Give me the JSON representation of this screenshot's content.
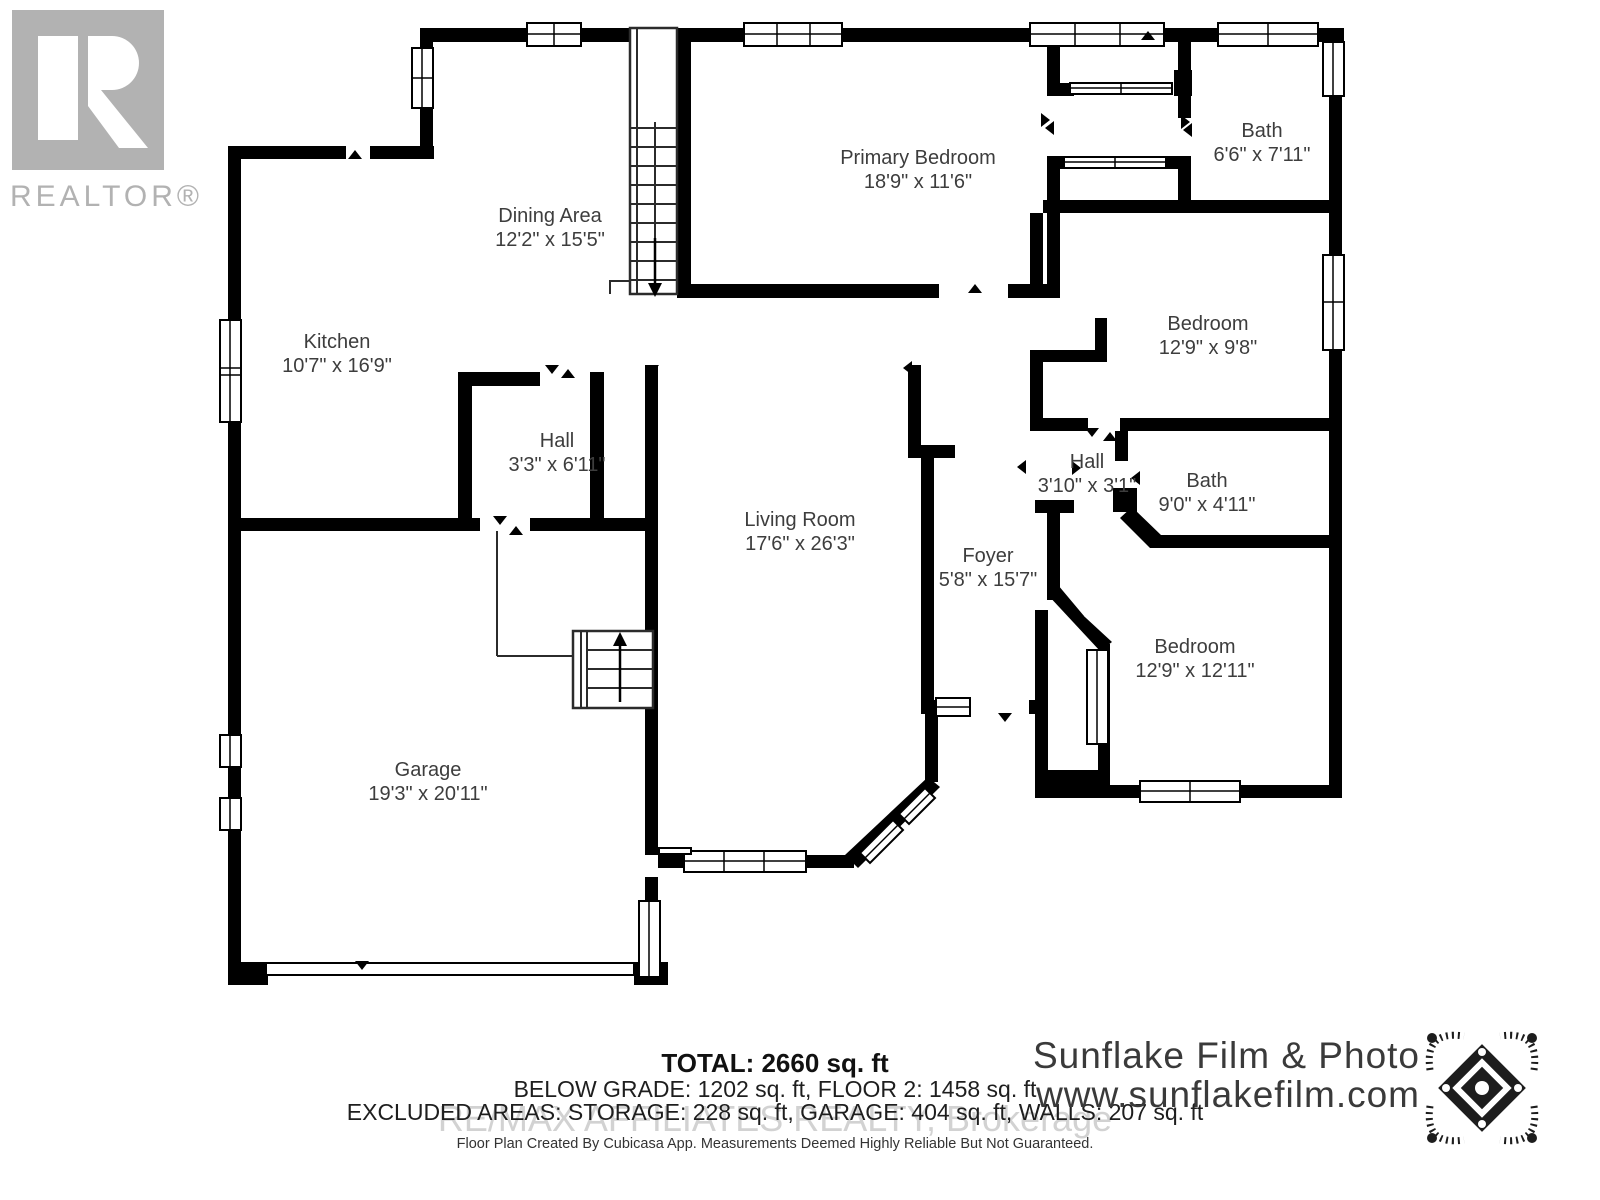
{
  "realtor": {
    "label": "REALTOR®"
  },
  "rooms": [
    {
      "name": "Dining Area",
      "dims": "12'2\" x 15'5\""
    },
    {
      "name": "Kitchen",
      "dims": "10'7\" x 16'9\""
    },
    {
      "name": "Hall",
      "dims": "3'3\" x 6'11\""
    },
    {
      "name": "Primary Bedroom",
      "dims": "18'9\" x 11'6\""
    },
    {
      "name": "Bath",
      "dims": "6'6\" x 7'11\""
    },
    {
      "name": "Bedroom",
      "dims": "12'9\" x 9'8\""
    },
    {
      "name": "Hall",
      "dims": "3'10\" x 3'1\""
    },
    {
      "name": "Bath",
      "dims": "9'0\" x 4'11\""
    },
    {
      "name": "Living Room",
      "dims": "17'6\" x 26'3\""
    },
    {
      "name": "Foyer",
      "dims": "5'8\" x 15'7\""
    },
    {
      "name": "Bedroom",
      "dims": "12'9\" x 12'11\""
    },
    {
      "name": "Garage",
      "dims": "19'3\" x 20'11\""
    }
  ],
  "summary": {
    "total": "TOTAL: 2660 sq. ft",
    "grades": "BELOW GRADE: 1202 sq. ft, FLOOR 2: 1458 sq. ft",
    "excluded": "EXCLUDED AREAS: STORAGE: 228 sq. ft, GARAGE: 404 sq. ft, WALLS: 207 sq. ft",
    "watermark": "RE/MAX AFFILIATES REALTY, Brokerage",
    "disclaimer": "Floor Plan Created By Cubicasa App. Measurements Deemed Highly Reliable But Not Guaranteed."
  },
  "brand": {
    "name": "Sunflake Film & Photo",
    "url": "www.sunflakefilm.com"
  },
  "colors": {
    "wall": "#000000",
    "label": "#3d3d3d",
    "watermark": "#d2d2d2",
    "realtor_gray": "#b2b2b2"
  }
}
